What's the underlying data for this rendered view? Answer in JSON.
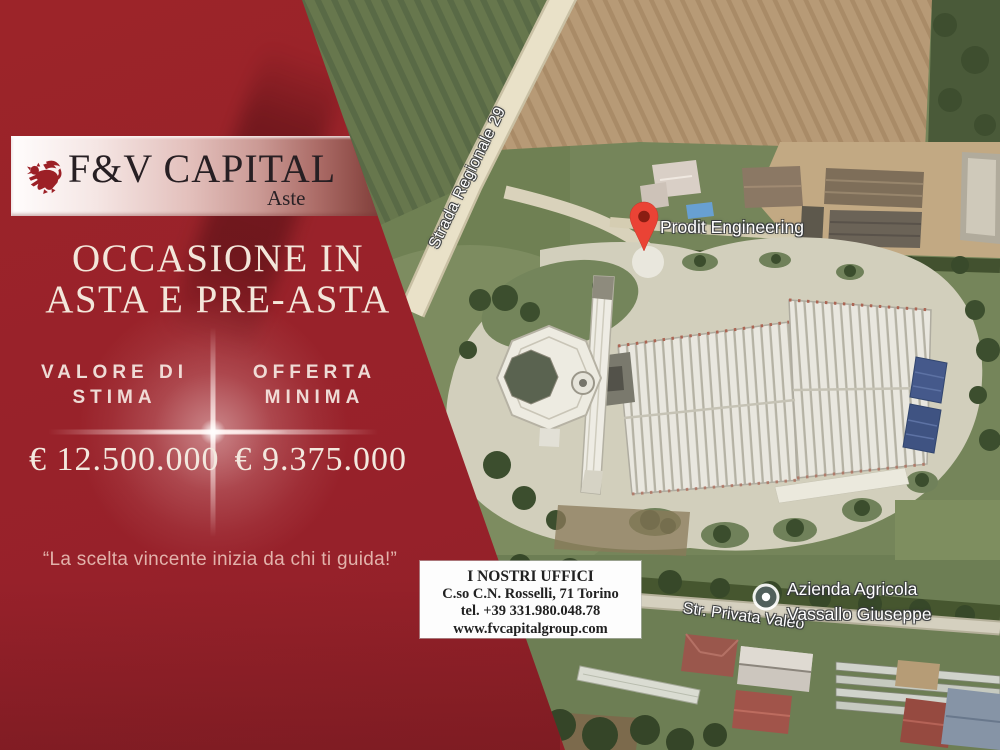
{
  "brand": {
    "name": "F&V CAPITAL",
    "subtitle": "Aste"
  },
  "headline": {
    "line1": "OCCASIONE IN",
    "line2": "ASTA E PRE-ASTA"
  },
  "pricing": {
    "estimate": {
      "label_line1": "VALORE DI",
      "label_line2": "STIMA",
      "value": "€ 12.500.000"
    },
    "minimum": {
      "label_line1": "OFFERTA",
      "label_line2": "MINIMA",
      "value": "€ 9.375.000"
    }
  },
  "quote": "“La scelta vincente inizia da chi ti guida!”",
  "contact": {
    "title": "I NOSTRI UFFICI",
    "address": "C.so C.N. Rosselli, 71 Torino",
    "phone": "tel. +39 331.980.048.78",
    "website": "www.fvcapitalgroup.com"
  },
  "map": {
    "labels": {
      "road_diagonal": "Strada Regionale 29",
      "business": "Prodit Engineering",
      "farm_line1": "Azienda Agricola",
      "farm_line2": "Vassallo Giuseppe",
      "road_bottom": "Str. Privata Valeo"
    },
    "markers": {
      "business_pin": "red-map-pin",
      "farm_poi": "gray-poi-circle"
    }
  },
  "colors": {
    "panel_red": "#982128",
    "panel_red_dark": "#6f1b21",
    "cream_text": "#f3e6da",
    "label_pink": "#eedbd5",
    "quote_pink": "#e2b2ab",
    "pin_red": "#ea4335",
    "banner_text": "#271f23"
  }
}
